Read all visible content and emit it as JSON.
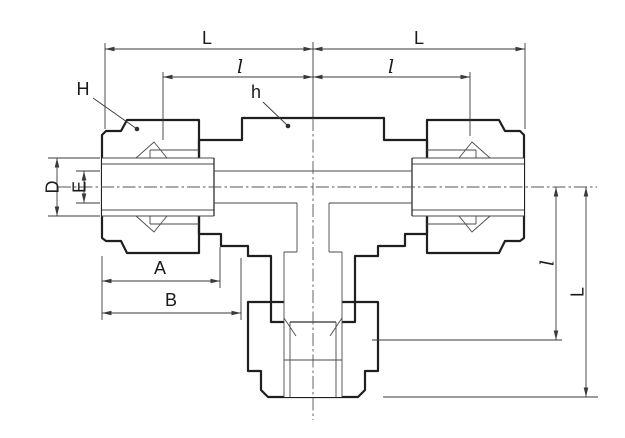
{
  "labels": {
    "L_top_left": "L",
    "l_top_left": "l",
    "L_top_right": "L",
    "l_top_right": "l",
    "H": "H",
    "h": "h",
    "D": "D",
    "E": "E",
    "A": "A",
    "B": "B",
    "l_right": "l",
    "L_right": "L"
  },
  "colors": {
    "background": "#ffffff",
    "body_fill": "#e7e6e4",
    "nut_fill": "#dcdbd9",
    "outline": "#1f1f1f",
    "dimension_lines": "#3a3a3a",
    "centerline": "#555555",
    "bore_fill": "#ffffff"
  }
}
